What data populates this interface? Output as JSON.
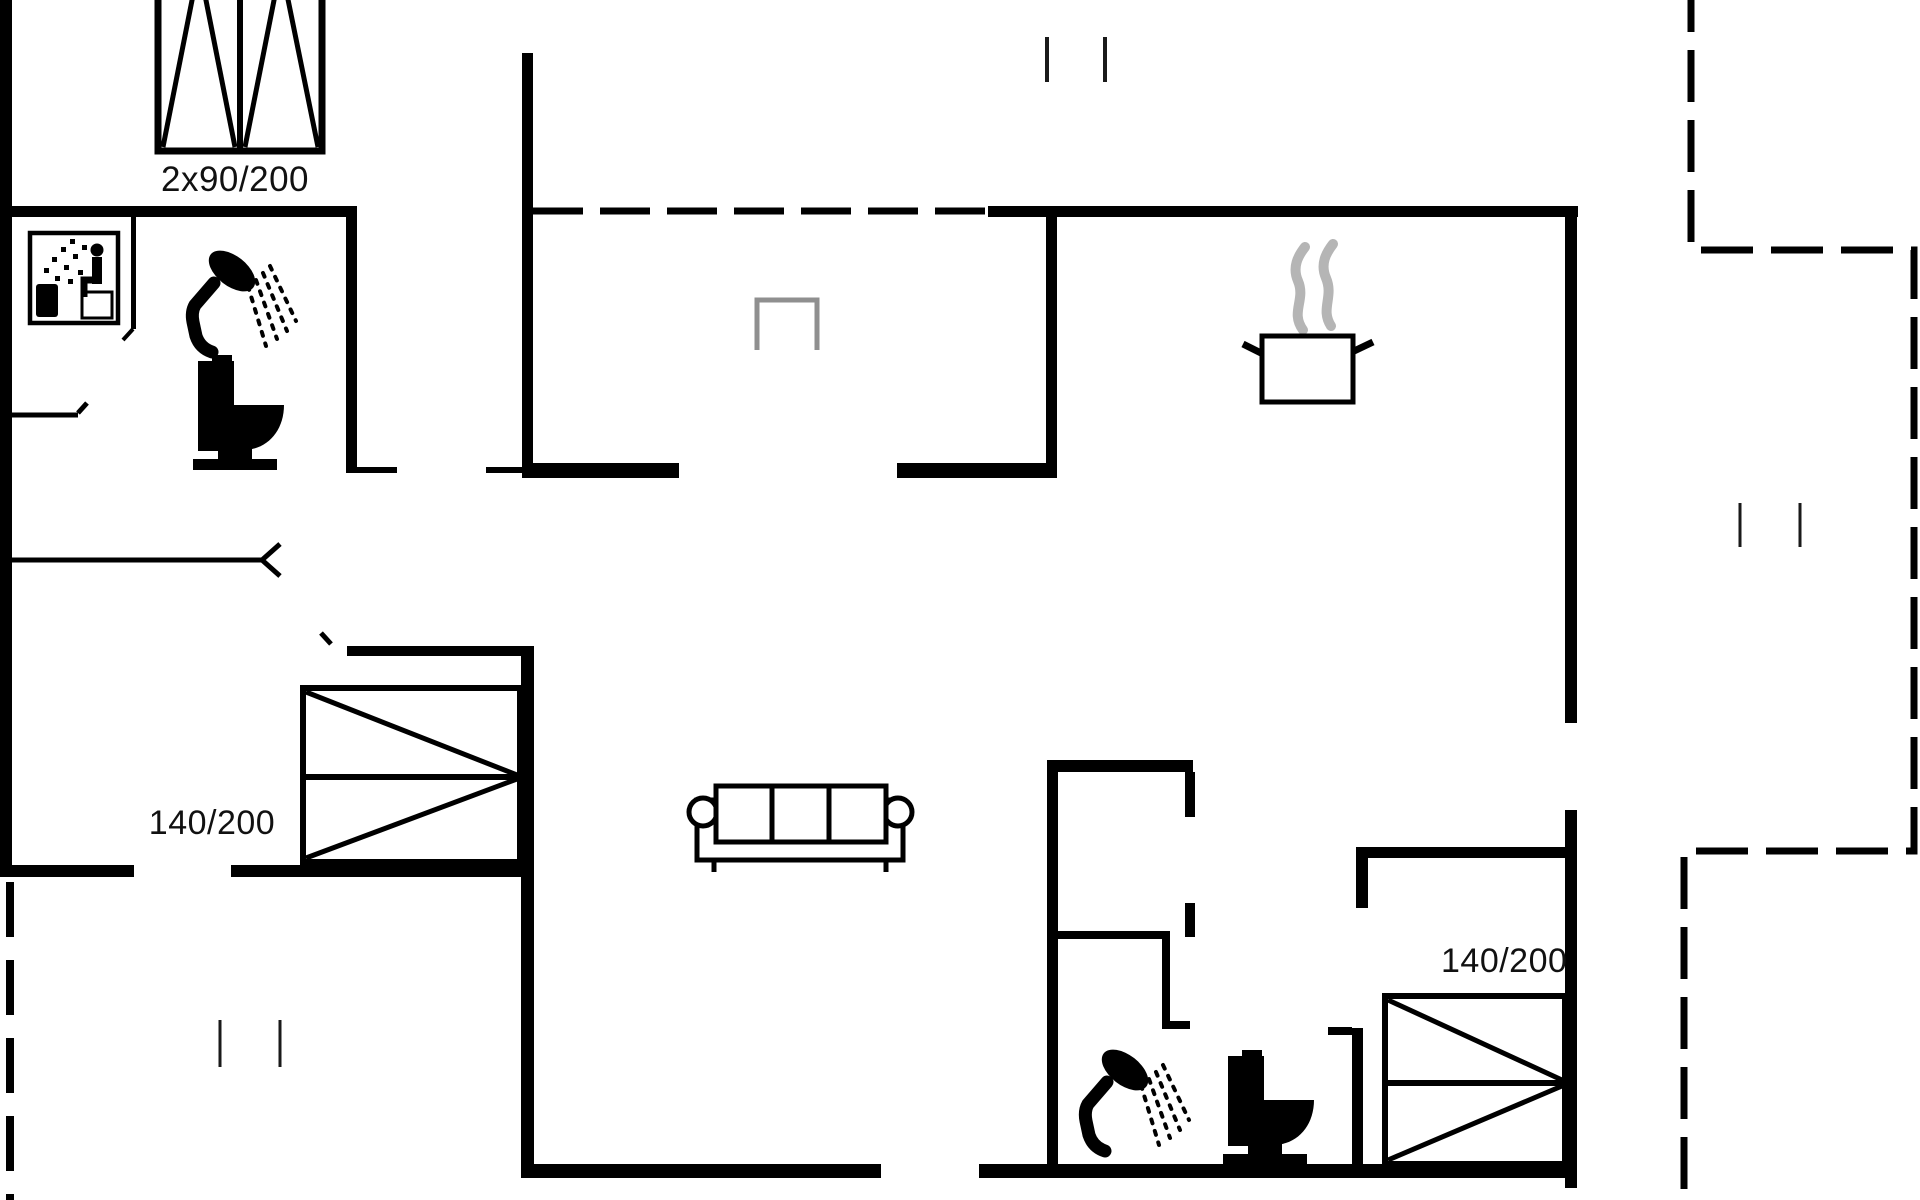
{
  "image_type": "floor-plan",
  "labels": {
    "bed_top_size": "2x90/200",
    "bed_left_size": "140/200",
    "bed_right_size": "140/200"
  },
  "colors": {
    "walls": "#000000",
    "background": "#ffffff",
    "steam_gray": "#b5b5b5",
    "entry_marker_gray": "#8f8f8f",
    "text": "#111111"
  },
  "icons": [
    "sauna-pictogram-icon",
    "shower-icon",
    "toilet-icon",
    "double-bed-2x90-icon",
    "double-bed-140x200-left-icon",
    "double-bed-140x200-right-icon",
    "sofa-icon",
    "cooking-pot-steam-icon",
    "entry-marker-icon",
    "window-tick-marks",
    "door-swing-marks",
    "terrace-dashed-boundary"
  ]
}
